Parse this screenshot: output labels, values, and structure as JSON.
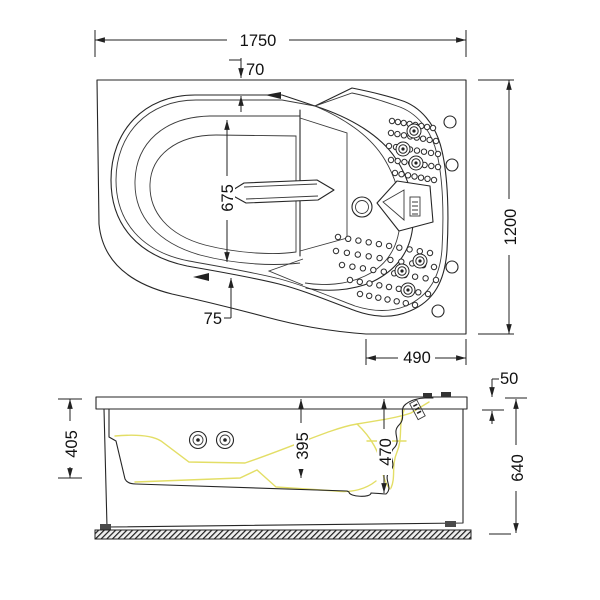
{
  "drawing": {
    "type": "bathtub technical drawing, top view and side view",
    "line_color": "#262626",
    "highlight_color": "#e3de66"
  },
  "dims": {
    "top": {
      "overall_length": "1750",
      "rim_inset_top": "70",
      "inner_width": "675",
      "rim_inset_bottom": "75",
      "seat_section": "490",
      "overall_width": "1200"
    },
    "side": {
      "rim_height": "50",
      "apron_height": "405",
      "basin_depth": "395",
      "deep_basin_depth": "470",
      "overall_height": "640"
    }
  }
}
